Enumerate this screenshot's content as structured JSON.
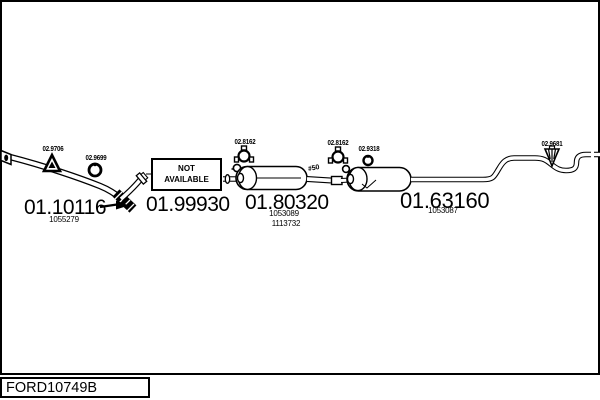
{
  "frame": {
    "catalog_code": "FORD10749B"
  },
  "not_available_box": {
    "line1": "NOT",
    "line2": "AVAILABLE"
  },
  "labels": {
    "hanger_front": "02.9706",
    "ring_front": "02.9699",
    "clamp_center": "02.8162",
    "clamp_rear": "02.8162",
    "ring_rear": "02.9318",
    "hanger_rear": "02.9681",
    "pipe_diameter": "#50"
  },
  "parts": {
    "front_pipe": {
      "number": "01.10116",
      "ref": "1055279"
    },
    "flex_section": {
      "number": "01.99930"
    },
    "center_muffler": {
      "number": "01.80320",
      "ref1": "1053089",
      "ref2": "1113732"
    },
    "rear_silencer": {
      "number": "01.63160",
      "ref": "1053087"
    }
  },
  "colors": {
    "line": "#000000",
    "background": "#ffffff"
  }
}
